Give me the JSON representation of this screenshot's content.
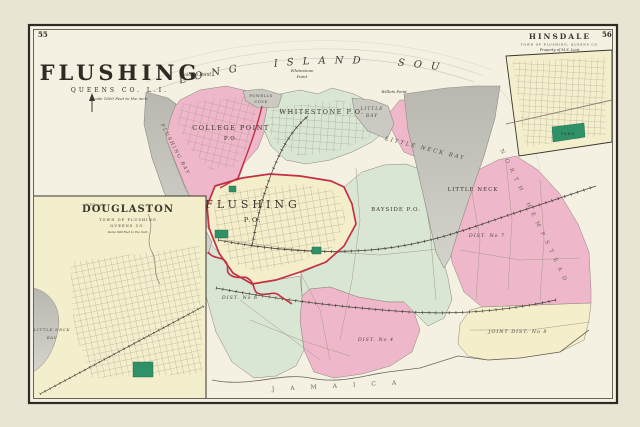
{
  "page_numbers": {
    "top_left": "55",
    "top_right": "56"
  },
  "title_block": {
    "title": "FLUSHING",
    "region_line": "QUEENS CO. L.I.",
    "scale_line": "Scale 1600 Feet to the inch."
  },
  "sound_label": "LONG ISLAND SOUND",
  "water": {
    "flushing_bay": "FLUSHING BAY",
    "powells_cove_line1": "POWELLS",
    "powells_cove_line2": "COVE",
    "little_bay_line1": "LITTLE",
    "little_bay_line2": "BAY",
    "little_neck_bay": "LITTLE NECK BAY"
  },
  "shore_labels": {
    "college_point": "College Point",
    "whitestone_point_line1": "Whitestone",
    "whitestone_point_line2": "Point",
    "willets_point": "Willets Point"
  },
  "settlements": {
    "college_point_line1": "COLLEGE POINT",
    "college_point_line2": "P.O.",
    "whitestone": "WHITESTONE P.O.",
    "flushing_line1": "FLUSHING",
    "flushing_line2": "P.O.",
    "bayside": "BAYSIDE P.O.",
    "little_neck": "LITTLE NECK"
  },
  "districts": {
    "no6": "DIST. No 6",
    "no4": "DIST. No 4",
    "no7": "DIST. No 7",
    "joint8": "JOINT DIST. No 8"
  },
  "neighbor_towns": {
    "south": "JAMAICA",
    "east": "NORTH HEMPSTEAD",
    "west": "NEWTOWN"
  },
  "insets": {
    "douglaston": {
      "title": "DOUGLASTON",
      "sub1": "TOWN OF FLUSHING",
      "sub2": "QUEENS CO.",
      "scale": "Scale 600 Feet to the inch.",
      "bay_line1": "LITTLE NECK",
      "bay_line2": "BAY",
      "owner": "W.P.Douglas"
    },
    "hinsdale": {
      "title": "HINSDALE",
      "sub1": "TOWN OF FLUSHING, QUEENS CO.",
      "sub2": "Property of M.S. Lent.",
      "park": "PARK"
    }
  },
  "colors": {
    "paper": "#e9e5d4",
    "map_background": "#f4f1e2",
    "water_gray": "#cbcac2",
    "village_pink": "#efb7ca",
    "village_green": "#d8e6d3",
    "village_yellow": "#f4eeca",
    "park_green": "#2f9168",
    "boundary_red": "#c23044",
    "frame_dark": "#2e2922"
  }
}
